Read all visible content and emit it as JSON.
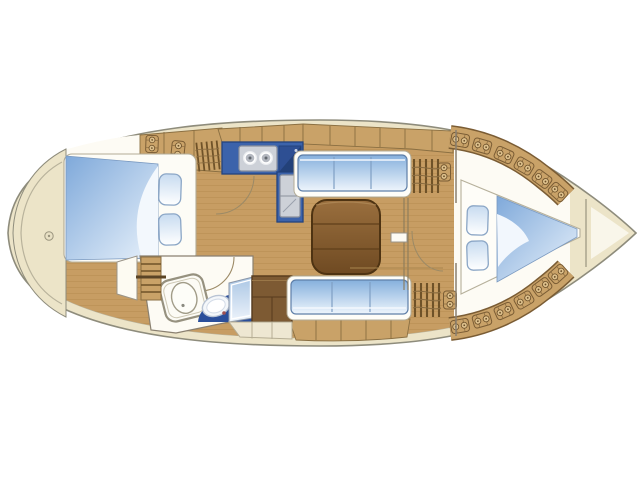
{
  "diagram": {
    "type": "yacht-interior-floor-plan",
    "description": "Top-down interior layout plan of a sailing yacht: rounded stern platform aft, aft double cabin, head compartment with shower and toilet, L-shaped galley with stove and sink, saloon with table and two settees, forward corridor, V-berth cabin and anchor locker in the bow"
  },
  "colors": {
    "hull_trim": "#ece4c8",
    "hull_outline": "#8e8c7c",
    "deck_line": "#b8b29b",
    "interior_white": "#fdfbf4",
    "wood_floor": "#c79d63",
    "cabinetry_tan": "#c9a268",
    "cabinetry_outline": "#7a5c34",
    "counter_blue": "#3c63ab",
    "counter_blue_dark": "#2e4f93",
    "counter_border": "#24437e",
    "appliance_gray": "#cdd1d8",
    "appliance_border": "#8b919c",
    "cushion_border": "#5f7fa8",
    "table_border": "#4e3312",
    "dark_cabinet": "#7d5a33",
    "toilet_blue": "#2a4e9a",
    "cream_locker": "#eee7d2",
    "wall_line": "#8a8070"
  },
  "regions": [
    "stern-platform",
    "aft-cabin",
    "head-compartment",
    "galley",
    "saloon",
    "nav-corridor",
    "v-berth-cabin",
    "anchor-locker"
  ],
  "fixtures": [
    "aft-double-berth",
    "pillows",
    "companionway-steps",
    "shower-basin",
    "toilet",
    "wet-locker-panel",
    "stove",
    "refrigerator",
    "sink",
    "saloon-table",
    "settee",
    "vent-slats",
    "locker-icon",
    "v-berth",
    "bow-blanket"
  ]
}
